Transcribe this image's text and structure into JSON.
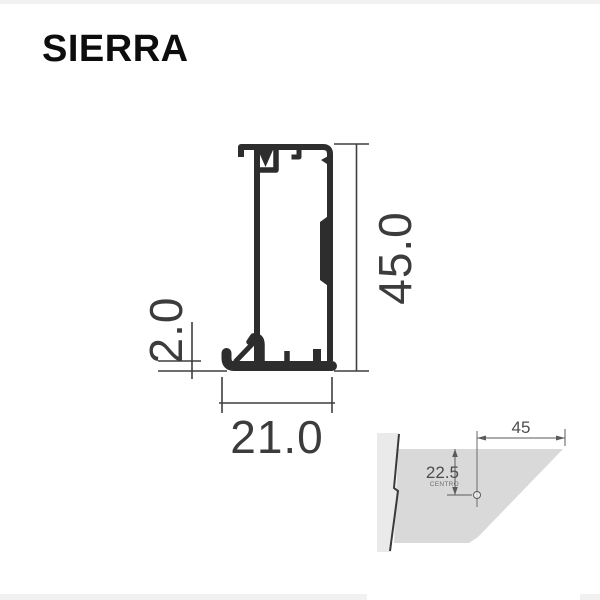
{
  "header": {
    "title": "SIERRA"
  },
  "cross_section": {
    "name": "aluminum-profile-cross-section",
    "dimensions": {
      "height_mm": "45.0",
      "width_mm": "21.0",
      "wall_thickness_mm": "2.0"
    }
  },
  "miter_detail": {
    "name": "miter-cut-drill-center-detail",
    "dimensions": {
      "length_mm": "45",
      "center_offset_mm": "22.5",
      "center_caption": "CENTRO"
    }
  },
  "colors": {
    "profile_line": "#2d2d2d",
    "dimension_line": "#3f3f3f",
    "detail_fill": "#d9d9d9",
    "wall_strip_fill": "#eaeaea",
    "edge_strip": "#f1f1f1"
  }
}
